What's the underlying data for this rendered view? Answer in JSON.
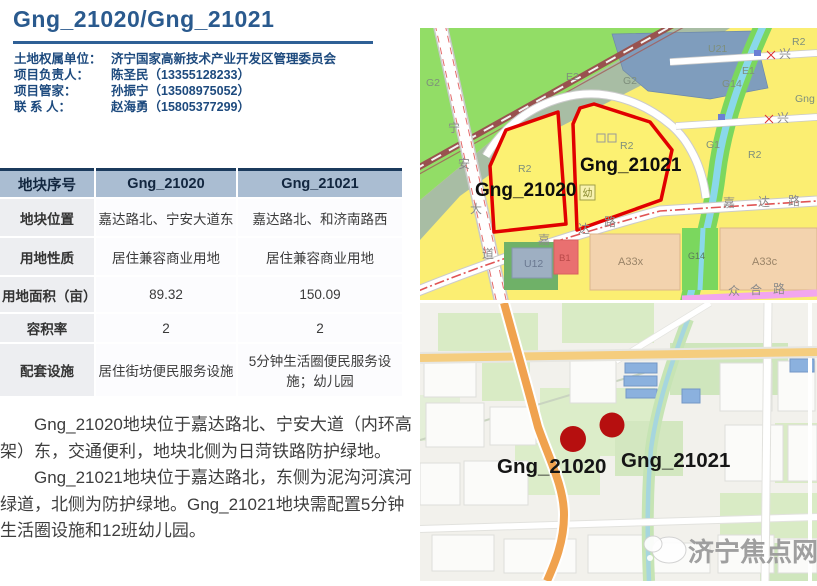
{
  "header": {
    "title": "Gng_21020/Gng_21021"
  },
  "contacts": {
    "rows": [
      {
        "label": "土地权属单位：",
        "value": "济宁国家高新技术产业开发区管理委员会"
      },
      {
        "label": "项目负责人：",
        "value": "陈圣民（13355128233）"
      },
      {
        "label": "项目管家：",
        "value": "孙振宁（13508975052）"
      },
      {
        "label": "联 系 人：",
        "value": "赵海勇（15805377299）"
      }
    ]
  },
  "table": {
    "header": [
      "地块序号",
      "Gng_21020",
      "Gng_21021"
    ],
    "rows": [
      [
        "地块位置",
        "嘉达路北、宁安大道东",
        "嘉达路北、和济南路西"
      ],
      [
        "用地性质",
        "居住兼容商业用地",
        "居住兼容商业用地"
      ],
      [
        "用地面积（亩）",
        "89.32",
        "150.09"
      ],
      [
        "容积率",
        "2",
        "2"
      ],
      [
        "配套设施",
        "居住街坊便民服务设施",
        "5分钟生活圈便民服务设施；幼儿园"
      ]
    ]
  },
  "paragraphs": [
    "Gng_21020地块位于嘉达路北、宁安大道（内环高架）东，交通便利，地块北侧为日菏铁路防护绿地。",
    "Gng_21021地块位于嘉达路北，东侧为泥沟河滨河绿道，北侧为防护绿地。Gng_21021地块需配置5分钟生活圈设施和12班幼儿园。"
  ],
  "zoning_map": {
    "parcel1": "Gng_21020",
    "parcel2": "Gng_21021",
    "zones": {
      "u21": "U21",
      "e2": "E2",
      "g2": "G2",
      "g2_left": "G2",
      "u12": "U12",
      "b1": "B1",
      "a33x": "A33x",
      "a33c": "A33c",
      "r2_a": "R2",
      "r2_b": "R2",
      "r2_c": "R2",
      "r2_d": "R2",
      "e1": "E1",
      "g14": "G14",
      "g14_b": "G14",
      "g1": "G1",
      "gng_edge": "Gng",
      "kindergarten": "幼"
    },
    "roads": {
      "ning": "宁",
      "an": "安",
      "dac": "大",
      "dao": "道",
      "jia1": "嘉",
      "da1": "达",
      "lu1": "路",
      "jia2": "嘉",
      "da2": "达",
      "lu2": "路",
      "zhong": "众",
      "he": "合",
      "lu3": "路",
      "xing1": "兴",
      "xing2": "兴"
    }
  },
  "street_map": {
    "marker1": "Gng_21020",
    "marker2": "Gng_21021",
    "watermark": "济宁焦点网"
  },
  "colors": {
    "accent_blue": "#2a5a8e",
    "table_header_bg": "#aabdd2",
    "parcel_outline": "#e10000",
    "marker_red": "#b60f0f",
    "zone_yellow": "#fbee72",
    "zone_green": "#92dd66"
  }
}
